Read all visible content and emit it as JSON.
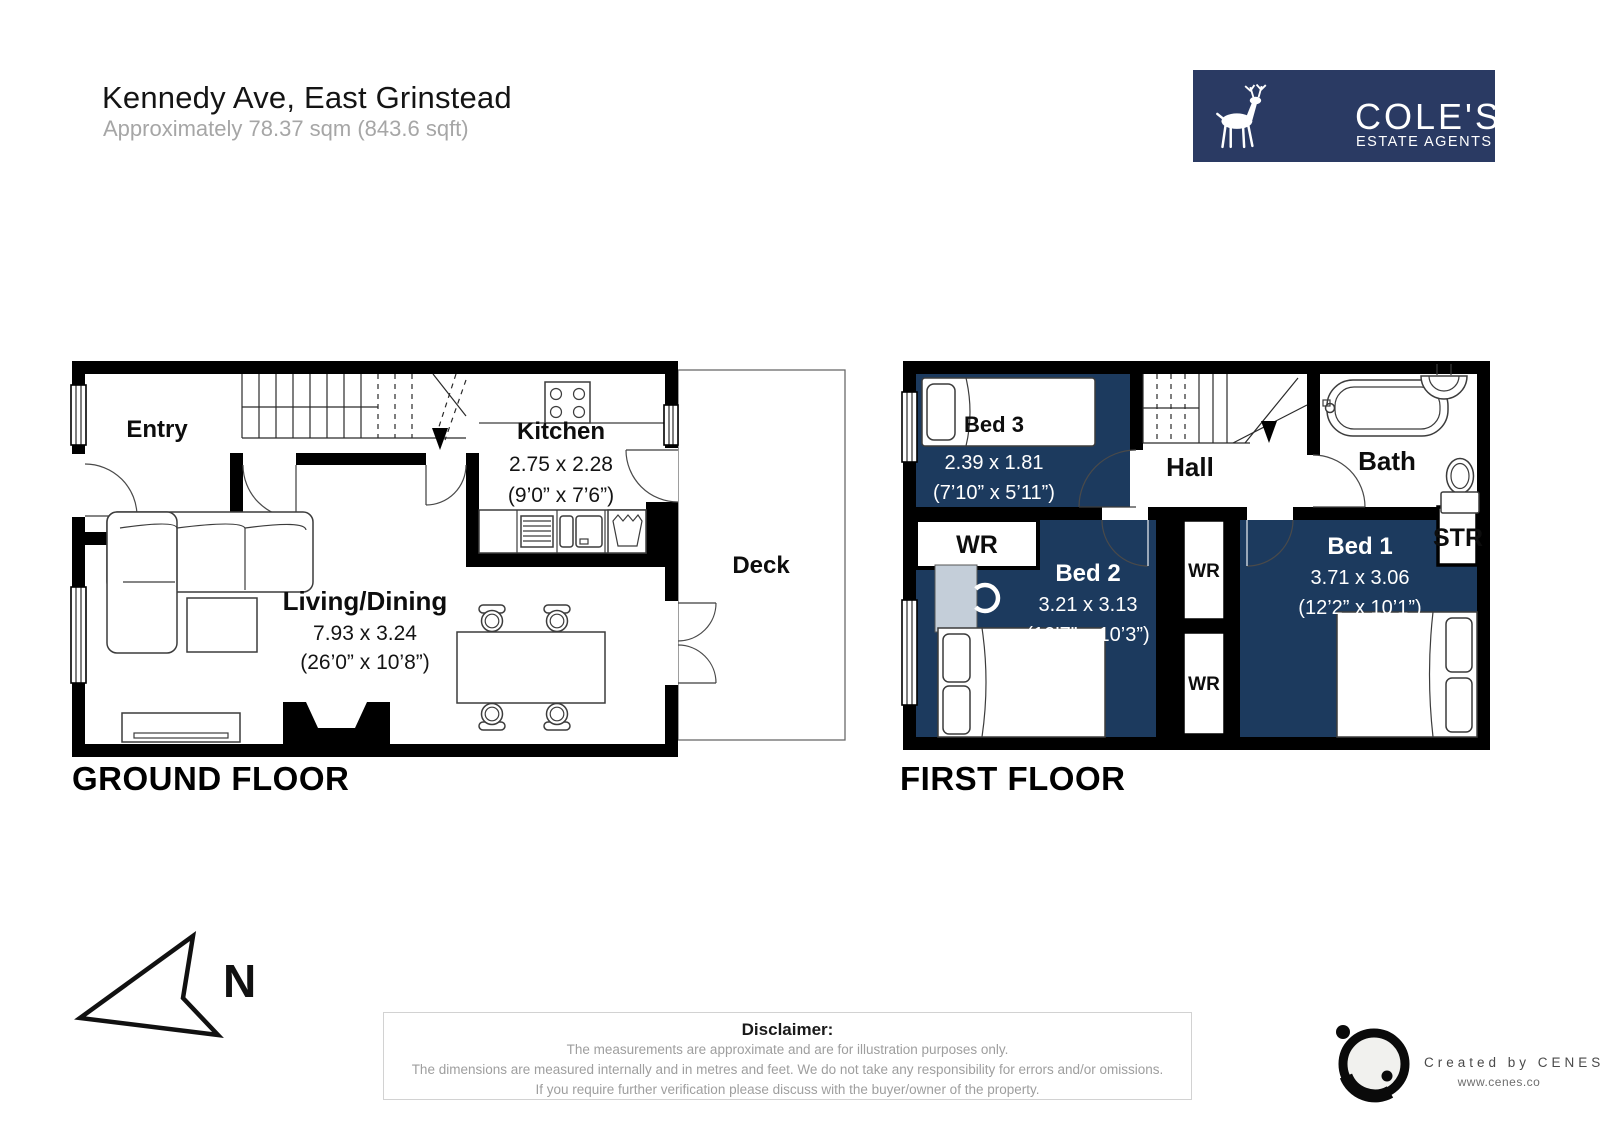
{
  "header": {
    "title": "Kennedy Ave, East Grinstead",
    "subtitle": "Approximately 78.37 sqm (843.6 sqft)"
  },
  "brand": {
    "name": "COLE'S",
    "tagline": "ESTATE AGENTS"
  },
  "floors": {
    "ground": {
      "label": "GROUND FLOOR",
      "entry": {
        "name": "Entry"
      },
      "kitchen": {
        "name": "Kitchen",
        "dims_m": "2.75 x 2.28",
        "dims_ft": "(9’0” x 7’6”)"
      },
      "living": {
        "name": "Living/Dining",
        "dims_m": "7.93 x 3.24",
        "dims_ft": "(26’0” x 10’8”)"
      },
      "deck": {
        "name": "Deck"
      }
    },
    "first": {
      "label": "FIRST FLOOR",
      "bed3": {
        "name": "Bed 3",
        "dims_m": "2.39 x 1.81",
        "dims_ft": "(7’10” x 5’11”)"
      },
      "bed2": {
        "name": "Bed 2",
        "dims_m": "3.21 x 3.13",
        "dims_ft": "(10’7” x 10’3”)"
      },
      "bed1": {
        "name": "Bed 1",
        "dims_m": "3.71 x 3.06",
        "dims_ft": "(12’2” x 10’1”)"
      },
      "hall": {
        "name": "Hall"
      },
      "bath": {
        "name": "Bath"
      },
      "wardrobe_label": "WR",
      "storage_label": "STR"
    }
  },
  "compass": {
    "north_label": "N"
  },
  "disclaimer": {
    "title": "Disclaimer:",
    "line1": "The measurements are approximate and are for illustration purposes only.",
    "line2": "The dimensions are measured internally and in metres and feet. We do not take any responsibility for errors and/or omissions.",
    "line3": "If you require further verification please discuss with the buyer/owner of the property."
  },
  "credit": {
    "text": "Created by CENES",
    "url": "www.cenes.co"
  },
  "colors": {
    "room_fill": "#1c3a5e",
    "logo_bg": "#2a3a63",
    "desk_fill": "#c4ced9"
  }
}
